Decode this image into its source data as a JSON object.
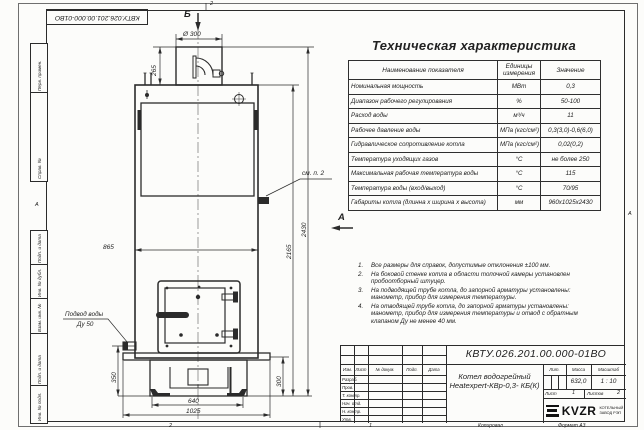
{
  "page": {
    "doc_number_top": "КВТУ.026.201.00.000-01ВО",
    "stamp_vertical": [
      "Перв. примен.",
      "Справ. №",
      "Подп. и дата",
      "Инв. № дубл.",
      "Взам. инв. №",
      "Подп. и дата",
      "Инв. № подл."
    ],
    "zones": {
      "top": "2",
      "bottom_left": "2",
      "bottom_right": "1",
      "left": "А",
      "right": "А"
    },
    "copy_label": "Копировал",
    "format_label": "Формат А3"
  },
  "spec_table": {
    "title": "Техническая характеристика",
    "headers": {
      "name": "Наименование показателя",
      "units": "Единицы измерения",
      "value": "Значение"
    },
    "rows": [
      {
        "name": "Номинальная мощность",
        "units": "МВт",
        "value": "0,3"
      },
      {
        "name": "Диапазон рабочего регулирования",
        "units": "%",
        "value": "50-100"
      },
      {
        "name": "Расход воды",
        "units": "м³/ч",
        "value": "11"
      },
      {
        "name": "Рабочее давление воды",
        "units": "МПа (кгс/см²)",
        "value": "0,3(3,0)-0,6(6,0)"
      },
      {
        "name": "Гидравлическое сопротивление котла",
        "units": "МПа (кгс/см²)",
        "value": "0,02(0,2)"
      },
      {
        "name": "Температура уходящих газов",
        "units": "°С",
        "value": "не более 250"
      },
      {
        "name": "Максимальная рабочая температура воды",
        "units": "°С",
        "value": "115"
      },
      {
        "name": "Температура воды (вход/выход)",
        "units": "°С",
        "value": "70/95"
      },
      {
        "name": "Габариты котла (длинна х ширина х высота)",
        "units": "мм",
        "value": "960х1025х2430"
      }
    ]
  },
  "notes": {
    "items": [
      {
        "num": "1.",
        "text": "Все размеры для справок, допустимые отклонения ±100 мм."
      },
      {
        "num": "2.",
        "text": "На боковой стенке котла в области топочной камеры установлен пробоотборный штуцер."
      },
      {
        "num": "3.",
        "text": "На подводящей трубе котла, до запорной арматуры установлены: манометр, прибор для измерения температуры."
      },
      {
        "num": "4.",
        "text": "На отводящей трубе котла, до запорной арматуры установлены: манометр, прибор для измерения температуры и отвод с обратным клапаном Ду не менее 40 мм."
      }
    ]
  },
  "drawing": {
    "view_a": "А",
    "view_b": "Б",
    "dims": {
      "d300": "Ø 300",
      "d265": "265",
      "d865": "865",
      "d2165": "2165",
      "d2430": "2430",
      "d350": "350",
      "d300b": "300",
      "d640": "640",
      "d1025": "1025"
    },
    "labels": {
      "see_note": "см. п. 2",
      "water_line1": "Подвод воды",
      "water_line2": "Ду 50"
    }
  },
  "title_block": {
    "doc_number": "КВТУ.026.201.00.000-01ВО",
    "product_line1": "Котел водогрейный",
    "product_line2": "Heatexpert-КВр-0,3- КБ(К)",
    "cols": {
      "izm": "Изм.",
      "list": "Лист",
      "doc": "№ докум.",
      "sign": "Подп.",
      "date": "Дата"
    },
    "rows": [
      "Разраб.",
      "Пров.",
      "Т. контр.",
      "Нач. отд.",
      "Н. контр.",
      "Утв."
    ],
    "lit_label": "Лит.",
    "mass_label": "Масса",
    "scale_label": "Масштаб",
    "mass": "632,0",
    "scale": "1 : 10",
    "sheet_label": "Лист",
    "sheet": "1",
    "sheets_label": "Листов",
    "sheets": "2",
    "logo_text": "KVZR",
    "logo_sub1": "КОТЕЛЬНЫЙ",
    "logo_sub2": "ЗАВОД РЭП"
  }
}
